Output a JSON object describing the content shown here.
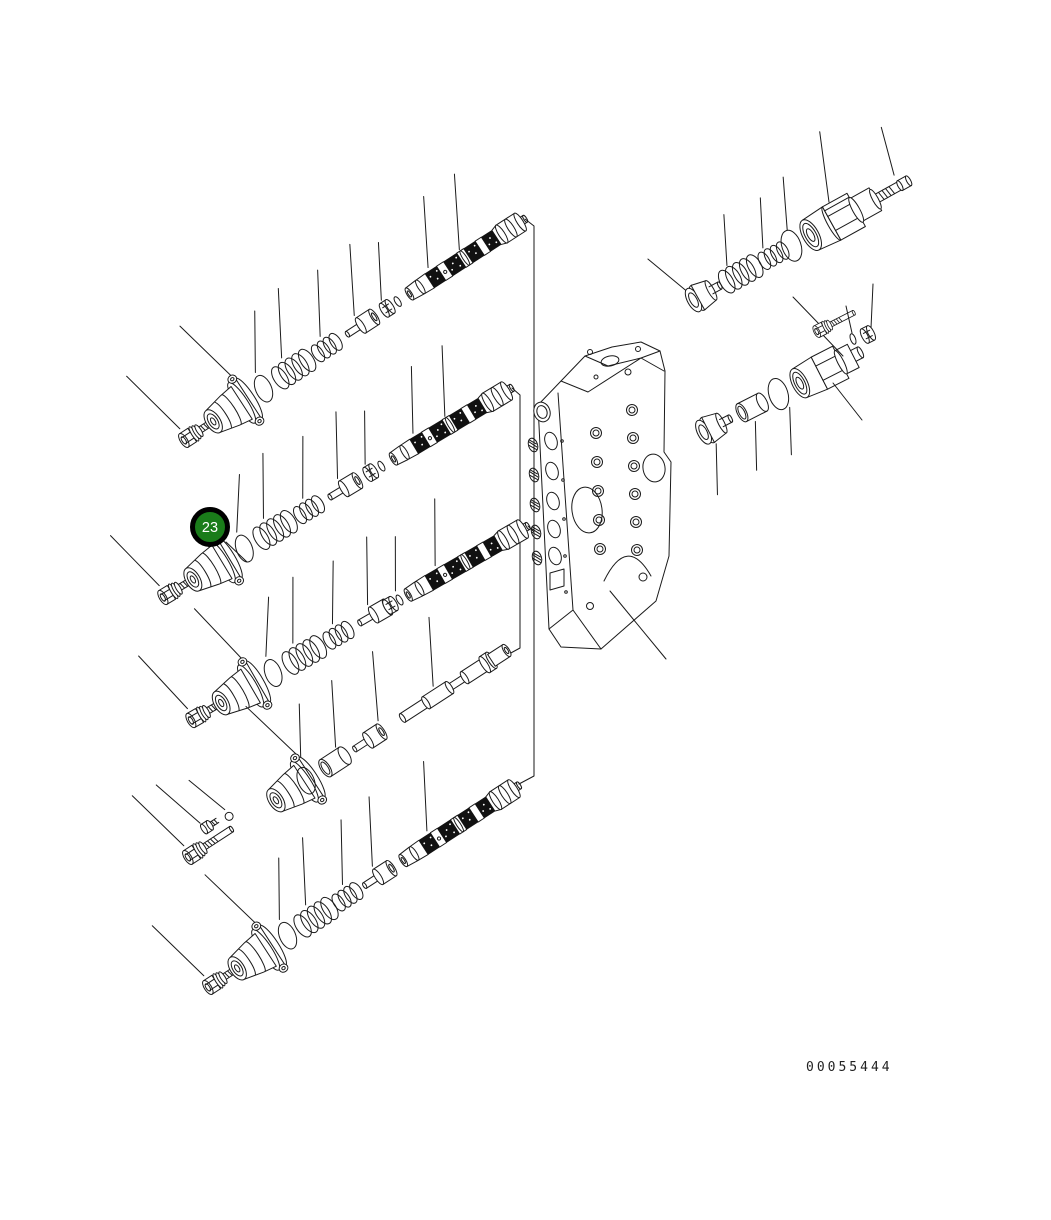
{
  "page": {
    "width": 1051,
    "height": 1220,
    "background": "#ffffff"
  },
  "diagram": {
    "title": "hydraulic-control-valve-exploded-view",
    "line_color": "#1a1a1a",
    "drawing_number": "00055444",
    "callout": {
      "number": "23",
      "fill_color": "#1a7c1a",
      "border_color": "#000000",
      "text_color": "#ffffff",
      "points_to": "end-cover"
    },
    "valve_body": {
      "name": "control-valve-body",
      "section_count": 5
    },
    "spool_sections": [
      {
        "name": "spool-section-1",
        "spool_type": "hatched",
        "parts": [
          "hex-socket-bolt",
          "end-cover",
          "o-ring",
          "outer-spring",
          "inner-spring",
          "spring-retainer",
          "collar-nut",
          "back-up-ring",
          "control-spool"
        ]
      },
      {
        "name": "spool-section-2",
        "spool_type": "hatched",
        "callout": "23",
        "parts": [
          "hex-socket-bolt",
          "end-cover",
          "o-ring",
          "outer-spring",
          "inner-spring",
          "spring-retainer",
          "collar-nut",
          "back-up-ring",
          "control-spool"
        ]
      },
      {
        "name": "spool-section-3",
        "spool_type": "hatched",
        "parts": [
          "hex-socket-bolt",
          "end-cover",
          "o-ring",
          "outer-spring",
          "inner-spring",
          "spring-retainer",
          "collar-nut",
          "back-up-ring",
          "control-spool"
        ]
      },
      {
        "name": "spool-section-4",
        "spool_type": "plain",
        "parts": [
          "hex-socket-bolt",
          "plug-screw",
          "steel-ball",
          "end-cover",
          "o-ring",
          "bushing-sleeve",
          "spring-retainer",
          "reducing-spool"
        ]
      },
      {
        "name": "spool-section-5",
        "spool_type": "hatched",
        "parts": [
          "hex-socket-bolt",
          "end-cover",
          "o-ring",
          "outer-spring",
          "inner-spring",
          "spring-retainer",
          "control-spool"
        ]
      }
    ],
    "relief_valves": [
      {
        "name": "relief-valve-upper",
        "parts": [
          "poppet-plug",
          "outer-spring",
          "inner-spring",
          "o-ring",
          "relief-cartridge",
          "adjusting-screw"
        ]
      },
      {
        "name": "relief-valve-lower",
        "parts": [
          "plug",
          "bushing-sleeve",
          "o-ring",
          "relief-cartridge",
          "hex-socket-bolt",
          "back-up-ring",
          "retaining-nut"
        ]
      }
    ]
  }
}
